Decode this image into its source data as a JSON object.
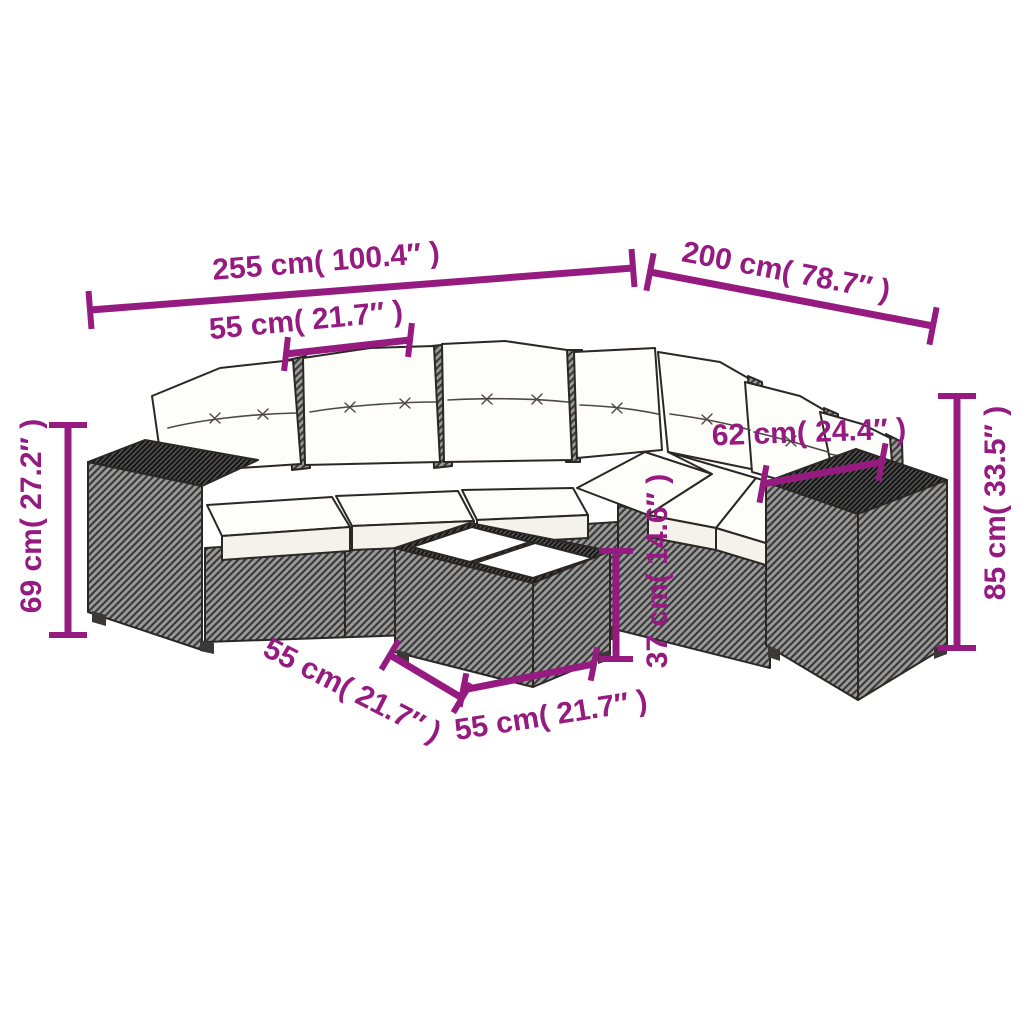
{
  "colors": {
    "dimension_accent": "#951b81",
    "outline": "#2b2724",
    "rattan_gray": "#9a9a9a",
    "rattan_dark": "#4e4e4e",
    "cushion_white": "#fdfdfa"
  },
  "dimensions": {
    "total_width": "255 cm( 100.4″ )",
    "total_depth": "200 cm( 78.7″ )",
    "seat_width": "55 cm( 21.7″ )",
    "armrest_height": "69 cm( 27.2″ )",
    "back_height": "85 cm( 33.5″ )",
    "corner_seat_depth": "62 cm( 24.4″ )",
    "table_height": "37 cm( 14.6″ )",
    "table_width": "55 cm( 21.7″ )",
    "table_depth": "55 cm( 21.7″ )"
  }
}
